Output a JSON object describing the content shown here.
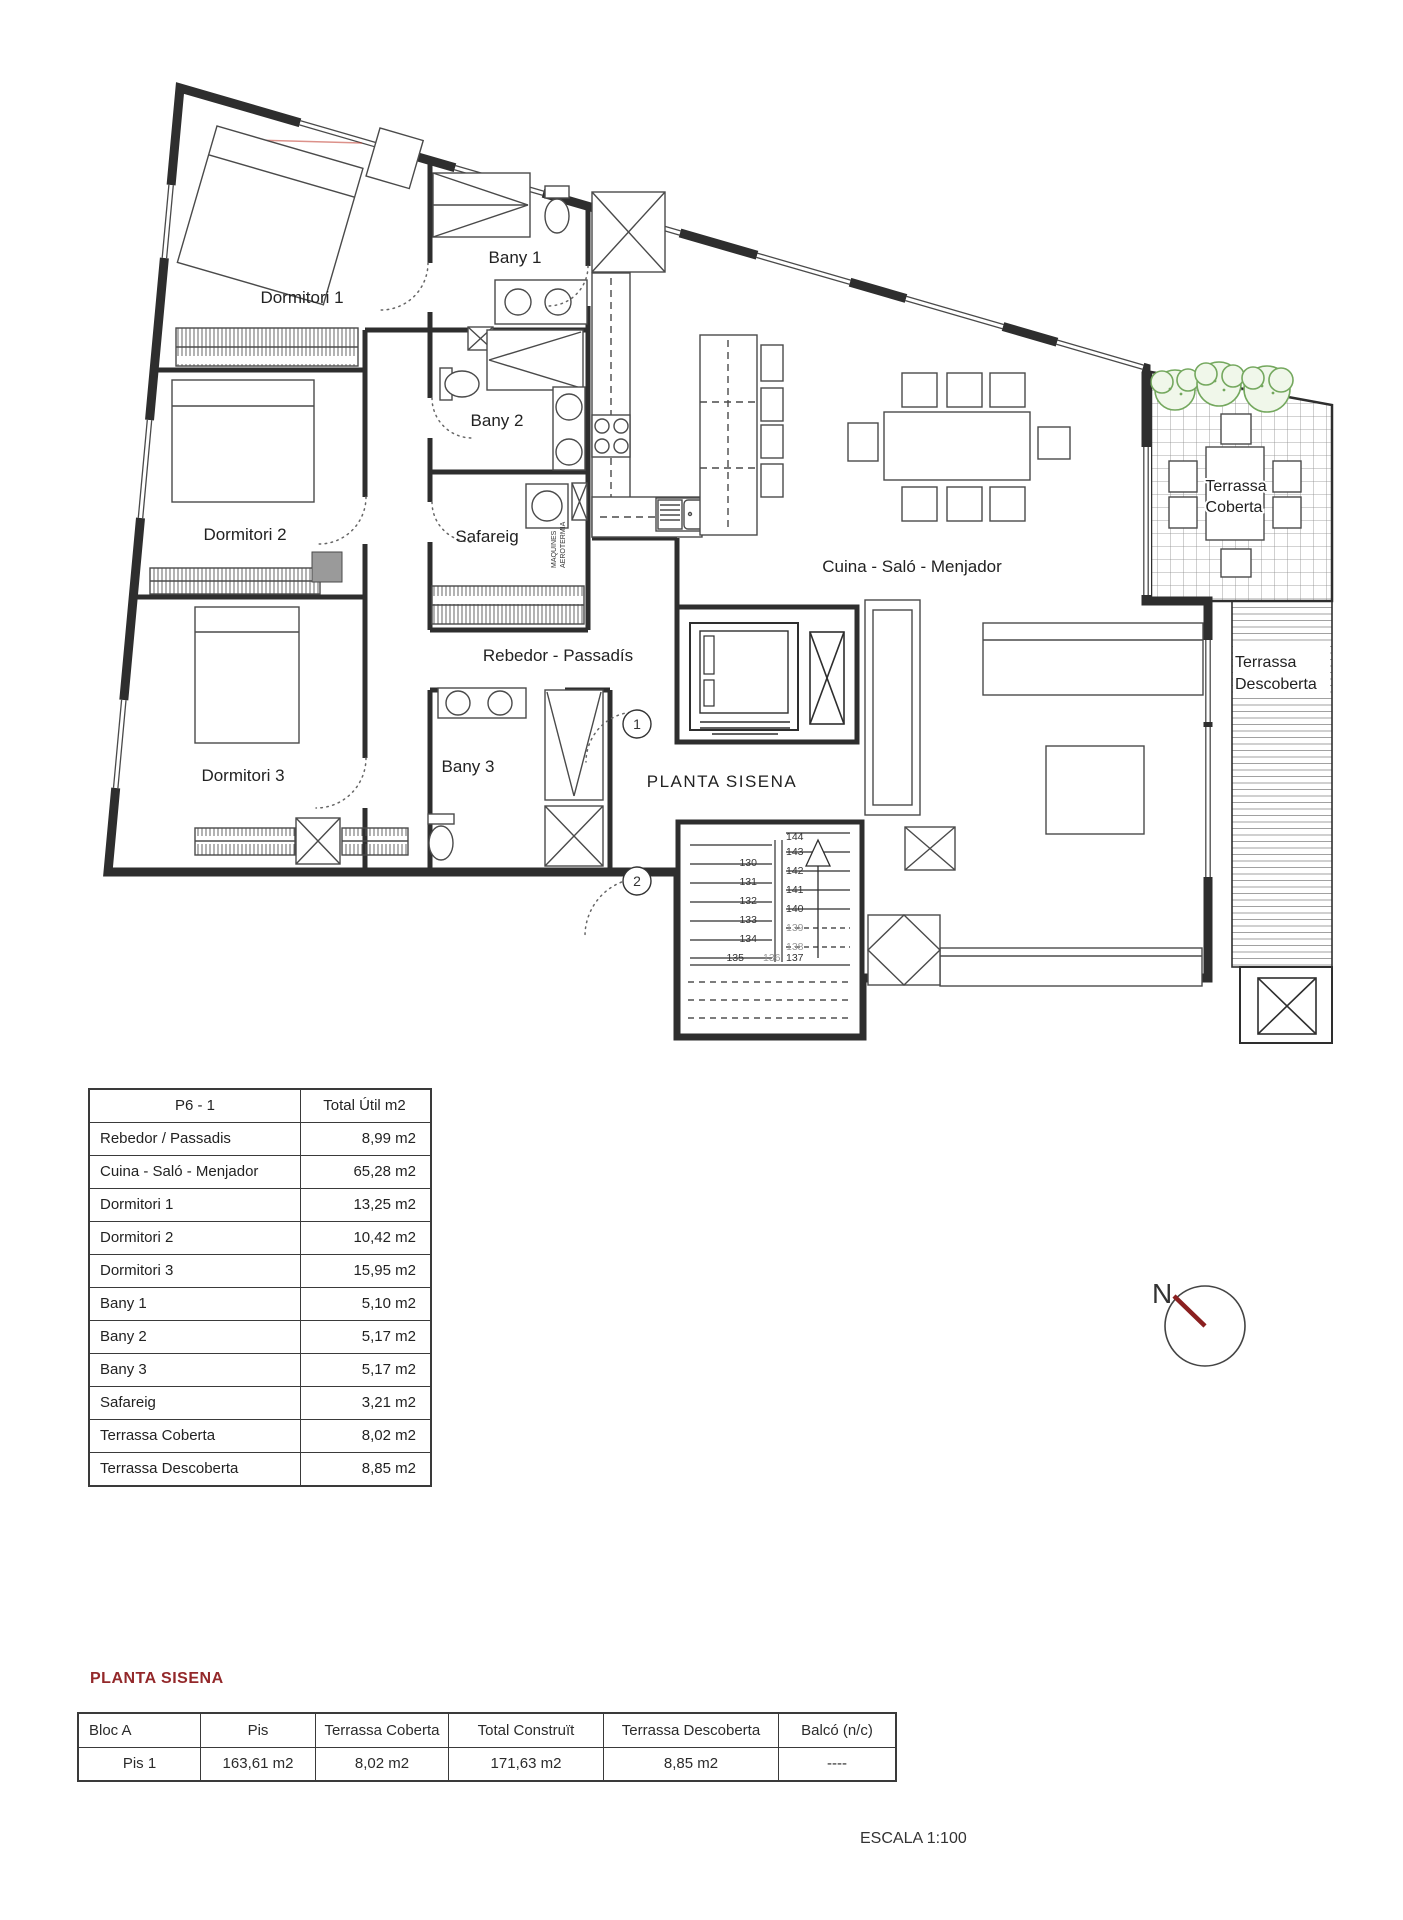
{
  "colors": {
    "line": "#2e2e2e",
    "furniture": "#4a4a4a",
    "accent_red": "#93282a",
    "compass_needle": "#8b2020",
    "bush_green": "#74a85e",
    "pillar_gray": "#9a9a9a"
  },
  "plan": {
    "room_labels": {
      "dormitori1": "Dormitori 1",
      "dormitori2": "Dormitori 2",
      "dormitori3": "Dormitori 3",
      "bany1": "Bany 1",
      "bany2": "Bany 2",
      "bany3": "Bany 3",
      "safareig": "Safareig",
      "rebedor": "Rebedor - Passadís",
      "cuina": "Cuina - Saló - Menjador",
      "planta": "PLANTA SISENA",
      "terrassa_coberta_l1": "Terrassa",
      "terrassa_coberta_l2": "Coberta",
      "terrassa_descoberta_l1": "Terrassa",
      "terrassa_descoberta_l2": "Descoberta",
      "maquines_l1": "MAQUINES",
      "maquines_l2": "AEROTERMIA"
    },
    "markers": {
      "m1": "1",
      "m2": "2"
    },
    "stair_numbers": {
      "n130": "130",
      "n131": "131",
      "n132": "132",
      "n133": "133",
      "n134": "134",
      "n135": "135",
      "n136": "136",
      "n137": "137",
      "n138": "138",
      "n139": "139",
      "n140": "140",
      "n141": "141",
      "n142": "142",
      "n143": "143",
      "n144": "144"
    },
    "compass": {
      "label": "N"
    }
  },
  "area_table": {
    "header": [
      "P6 - 1",
      "Total Útil m2"
    ],
    "rows": [
      [
        "Rebedor / Passadis",
        "8,99 m2"
      ],
      [
        "Cuina - Saló - Menjador",
        "65,28 m2"
      ],
      [
        "Dormitori 1",
        "13,25 m2"
      ],
      [
        "Dormitori 2",
        "10,42 m2"
      ],
      [
        "Dormitori 3",
        "15,95 m2"
      ],
      [
        "Bany 1",
        "5,10 m2"
      ],
      [
        "Bany 2",
        "5,17 m2"
      ],
      [
        "Bany 3",
        "5,17 m2"
      ],
      [
        "Safareig",
        "3,21 m2"
      ],
      [
        "Terrassa Coberta",
        "8,02 m2"
      ],
      [
        "Terrassa Descoberta",
        "8,85 m2"
      ]
    ]
  },
  "summary": {
    "heading": "PLANTA SISENA",
    "columns": [
      "Bloc A",
      "Pis",
      "Terrassa Coberta",
      "Total Construït",
      "Terrassa Descoberta",
      "Balcó (n/c)"
    ],
    "row": [
      "Pis 1",
      "163,61 m2",
      "8,02 m2",
      "171,63 m2",
      "8,85 m2",
      "----"
    ]
  },
  "scale_label": "ESCALA 1:100"
}
